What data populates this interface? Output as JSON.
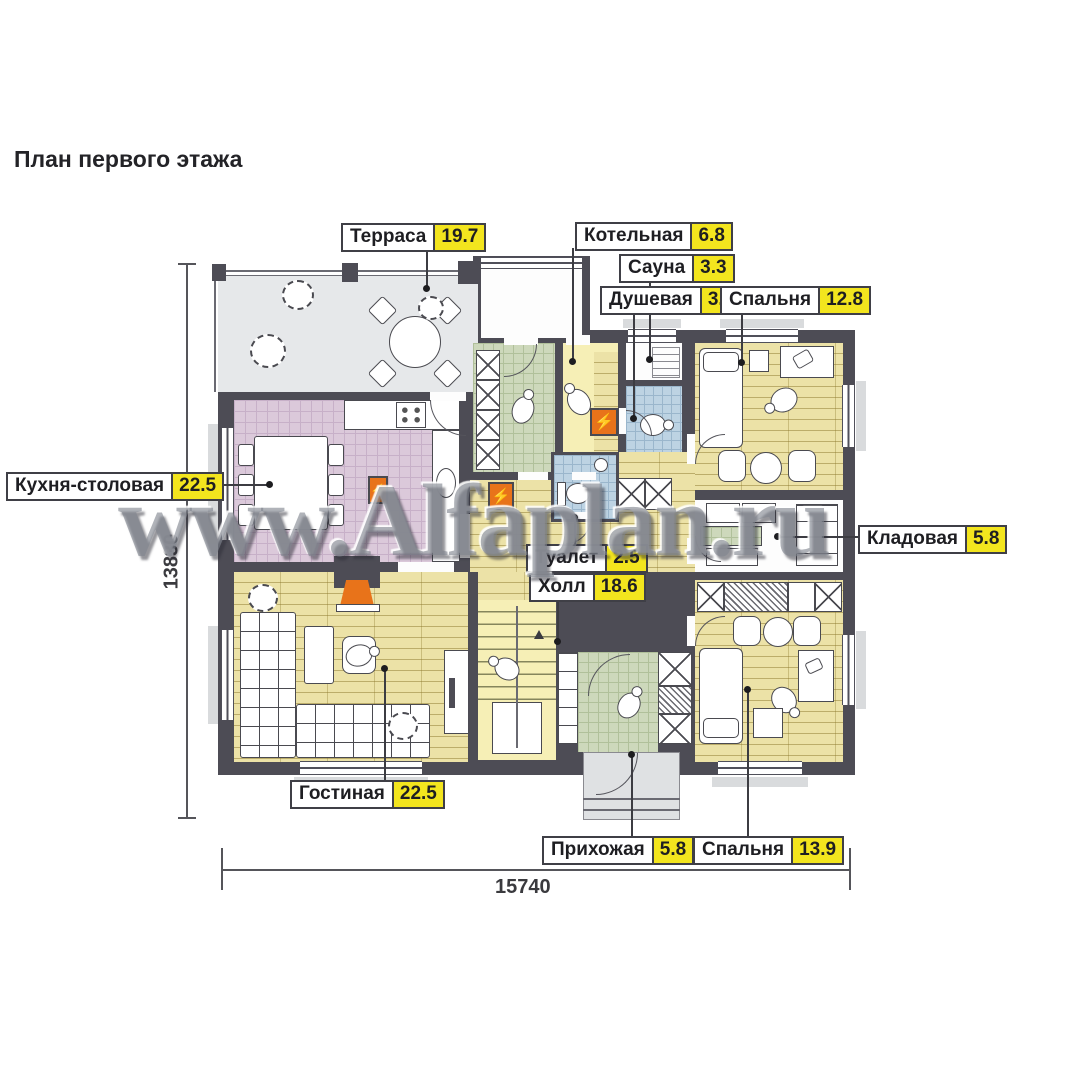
{
  "title": "План первого этажа",
  "watermark": "www.Alfaplan.ru",
  "dimensions": {
    "height_label": "13830",
    "width_label": "15740"
  },
  "colors": {
    "label_highlight": "#F3E51E",
    "wall": "#4D4C55",
    "accent_orange": "#E8731A",
    "floor_wood": "#ECE2A7",
    "floor_tile_pink": "#DBC9DA",
    "floor_tile_green": "#CDD8BB",
    "floor_tile_blue": "#BDD3E3",
    "terrace_gray": "#E6E8EA"
  },
  "symbols": {
    "boiler_lightning": "⚡"
  },
  "rooms": [
    {
      "name": "Терраса",
      "area": "19.7"
    },
    {
      "name": "Котельная",
      "area": "6.8"
    },
    {
      "name": "Сауна",
      "area": "3.3"
    },
    {
      "name": "Душевая",
      "area": "3.6"
    },
    {
      "name": "Спальня",
      "area": "12.8"
    },
    {
      "name": "Кухня-столовая",
      "area": "22.5"
    },
    {
      "name": "Кладовая",
      "area": "5.8"
    },
    {
      "name": "Туалет",
      "area": "2.5"
    },
    {
      "name": "Холл",
      "area": "18.6"
    },
    {
      "name": "Гостиная",
      "area": "22.5"
    },
    {
      "name": "Прихожая",
      "area": "5.8"
    },
    {
      "name": "Спальня",
      "area": "13.9"
    }
  ]
}
